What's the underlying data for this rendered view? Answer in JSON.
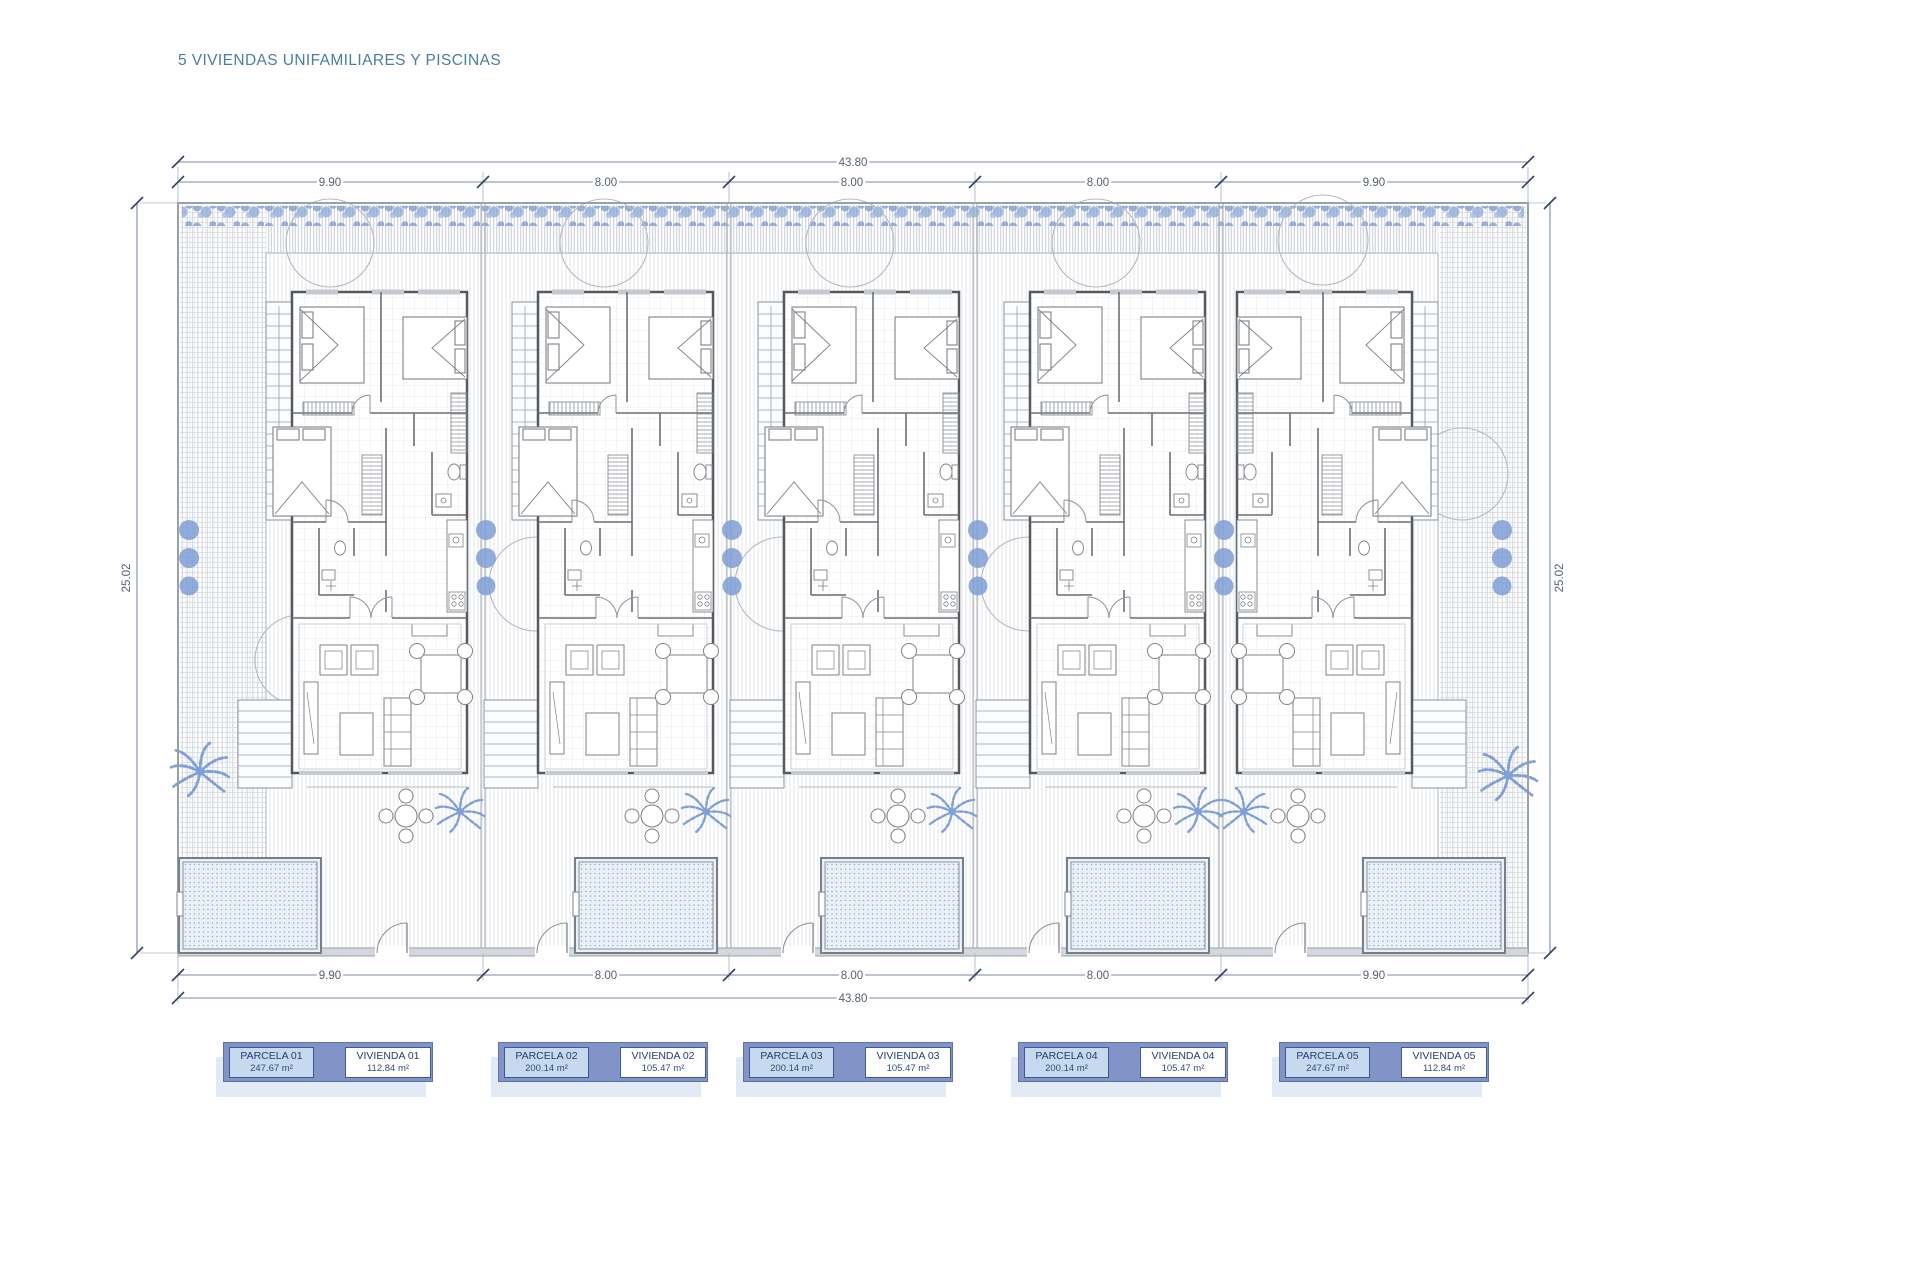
{
  "title": "5 VIVIENDAS UNIFAMILIARES Y PISCINAS",
  "dimensions": {
    "total_top": "43.80",
    "total_bottom": "43.80",
    "left_height": "25.02",
    "right_height": "25.02",
    "parcels_top": [
      "9.90",
      "8.00",
      "8.00",
      "8.00",
      "9.90"
    ],
    "parcels_bottom": [
      "9.90",
      "8.00",
      "8.00",
      "8.00",
      "9.90"
    ]
  },
  "legend": [
    {
      "parcel_label": "PARCELA 01",
      "parcel_area": "247.67 m²",
      "dwelling_label": "VIVIENDA 01",
      "dwelling_area": "112.84 m²"
    },
    {
      "parcel_label": "PARCELA 02",
      "parcel_area": "200.14 m²",
      "dwelling_label": "VIVIENDA 02",
      "dwelling_area": "105.47 m²"
    },
    {
      "parcel_label": "PARCELA 03",
      "parcel_area": "200.14 m²",
      "dwelling_label": "VIVIENDA 03",
      "dwelling_area": "105.47 m²"
    },
    {
      "parcel_label": "PARCELA 04",
      "parcel_area": "200.14 m²",
      "dwelling_label": "VIVIENDA 04",
      "dwelling_area": "105.47 m²"
    },
    {
      "parcel_label": "PARCELA 05",
      "parcel_area": "247.67 m²",
      "dwelling_label": "VIVIENDA 05",
      "dwelling_area": "112.84 m²"
    }
  ],
  "colors": {
    "title_text": "#4b7ca3",
    "accent_blue": "#7f9fd6",
    "legend_outer": "#8193c7",
    "legend_parcel_fill": "#c7d9ee",
    "legend_border": "#3a5a96",
    "legend_text": "#1e3f76",
    "dimension_text": "#555f70",
    "wall": "#55595e"
  }
}
